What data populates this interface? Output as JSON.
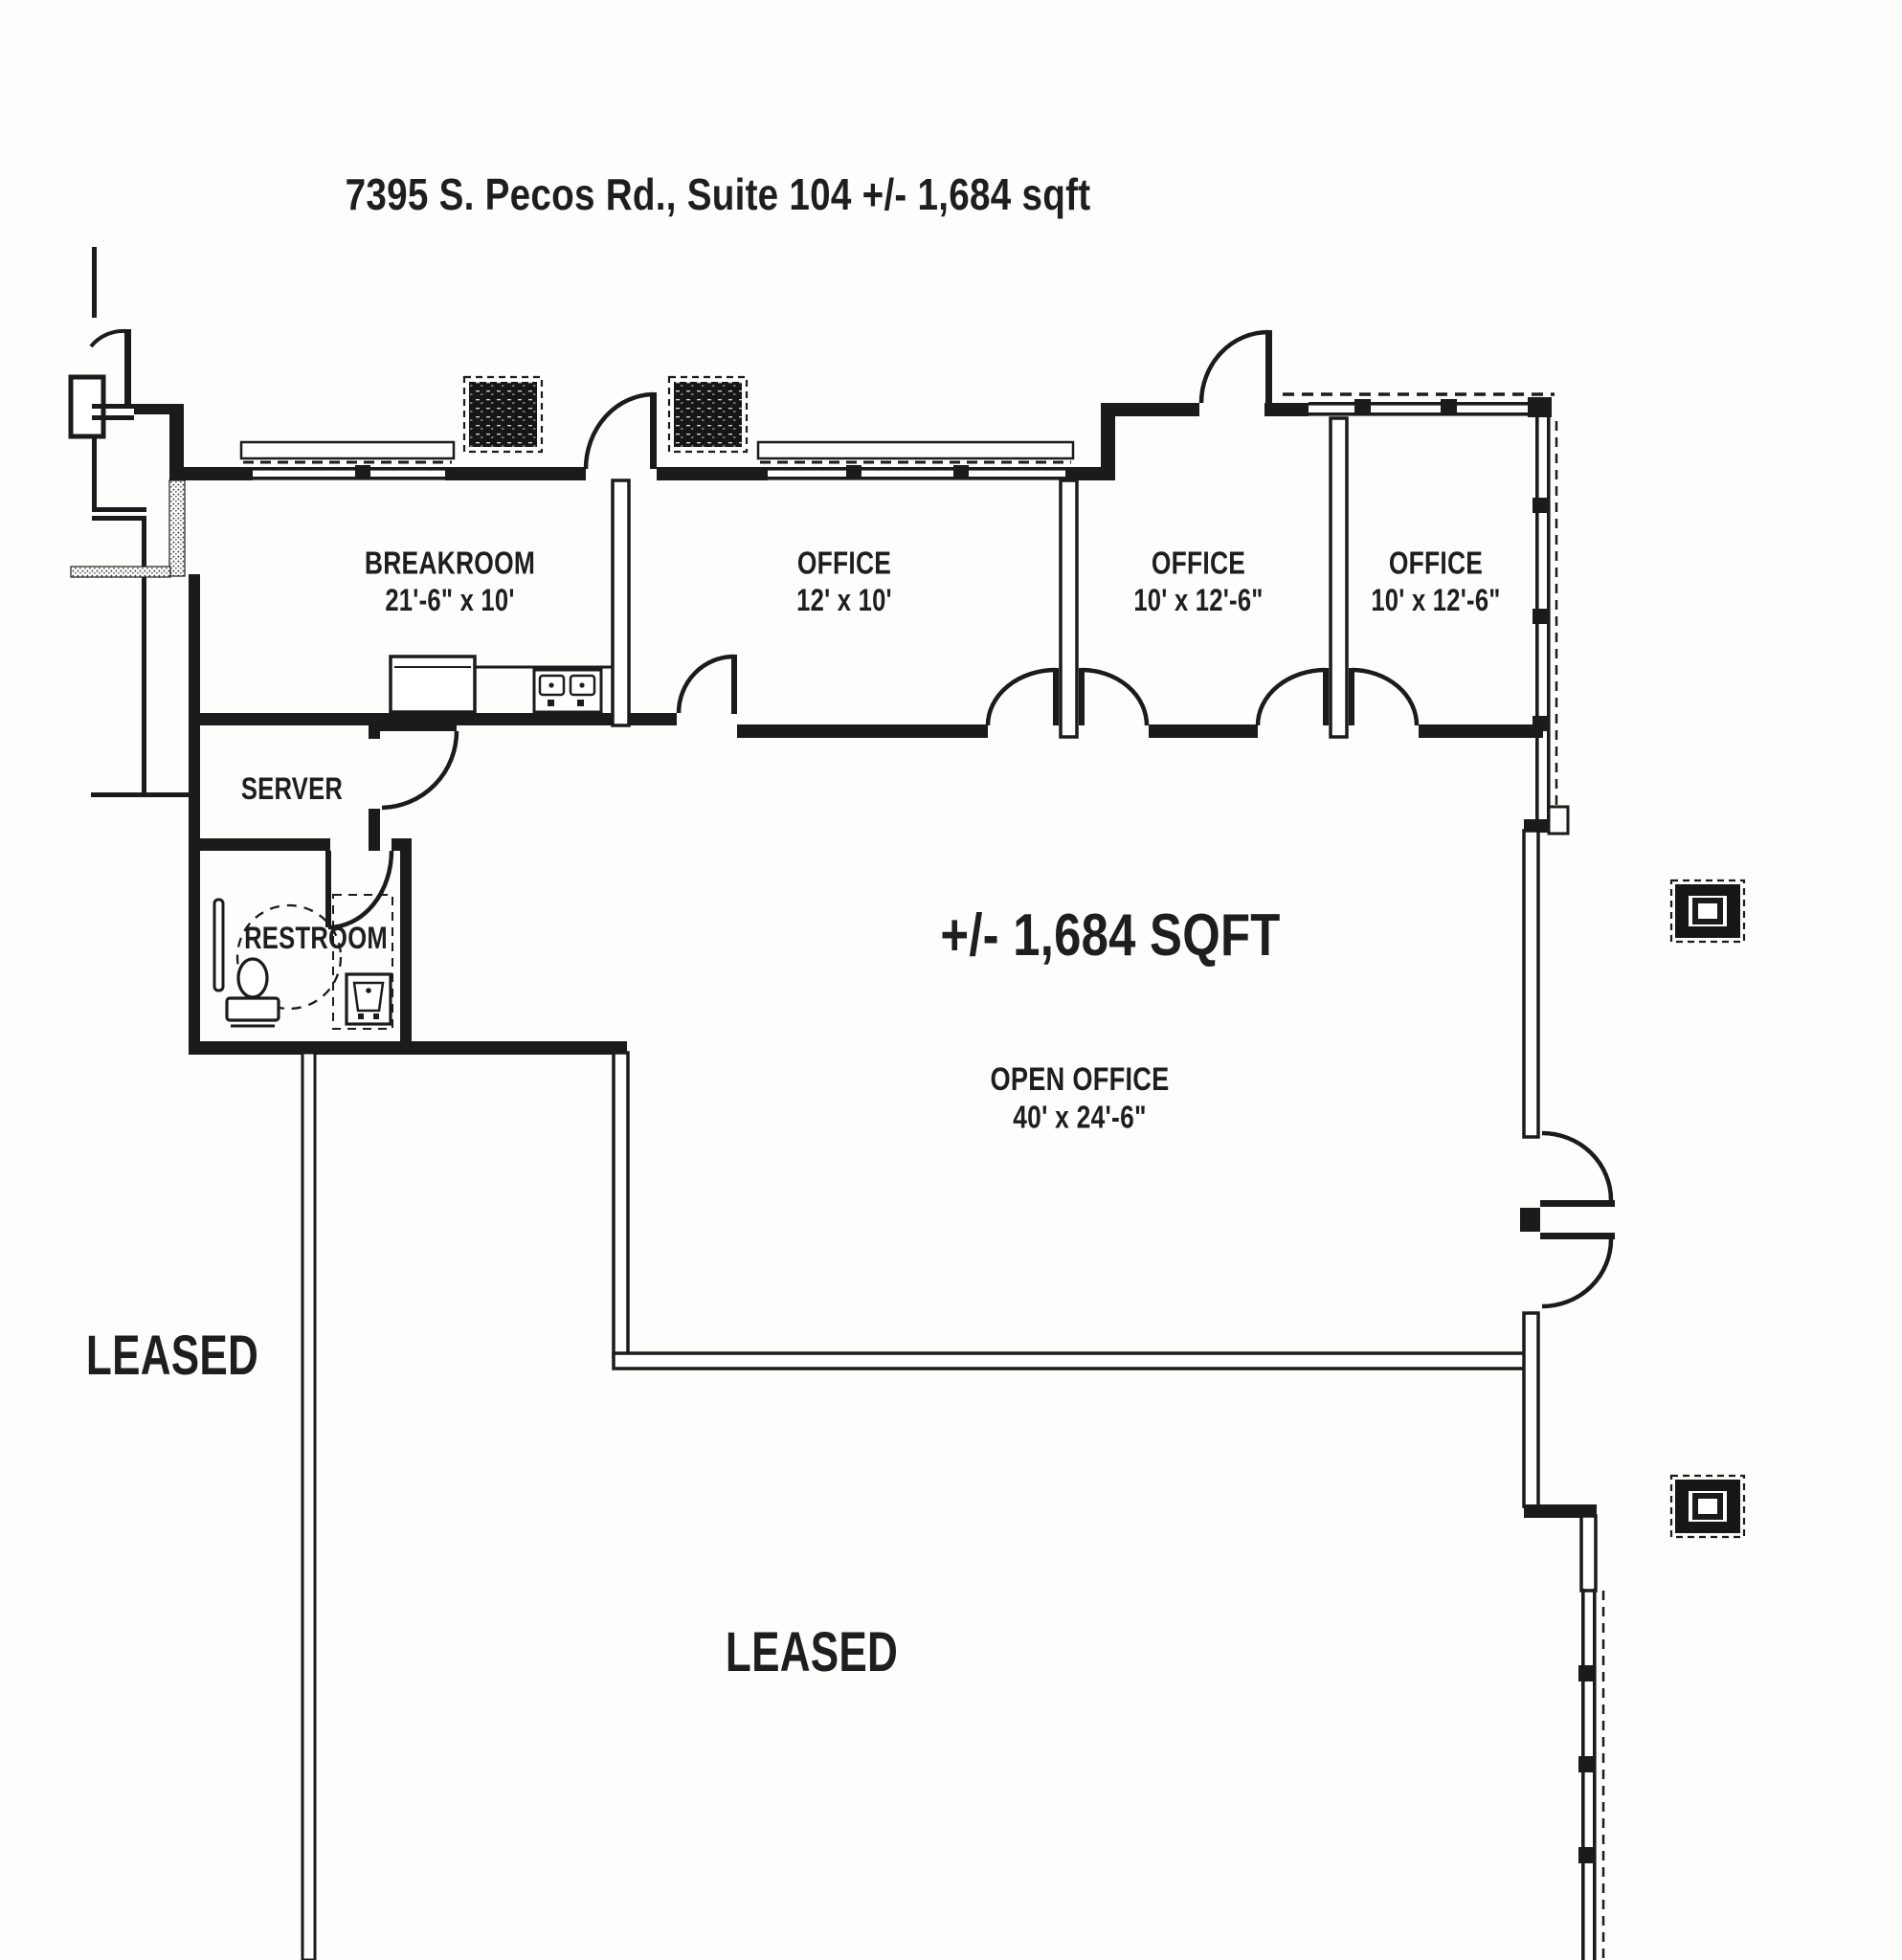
{
  "title": "7395 S. Pecos Rd., Suite 104   +/- 1,684 sqft",
  "plan": {
    "breakroom": {
      "name": "BREAKROOM",
      "dims": "21'-6\" x 10'"
    },
    "offices": [
      {
        "name": "OFFICE",
        "dims": "12' x 10'"
      },
      {
        "name": "OFFICE",
        "dims": "10' x 12'-6\""
      },
      {
        "name": "OFFICE",
        "dims": "10' x 12'-6\""
      }
    ],
    "server": {
      "name": "SERVER"
    },
    "restroom": {
      "name": "RESTROOM"
    },
    "open_office": {
      "area_text": "+/- 1,684 SQFT",
      "name": "OPEN OFFICE",
      "dims": "40' x 24'-6\""
    },
    "leased_left": {
      "name": "LEASED"
    },
    "leased_bottom": {
      "name": "LEASED"
    }
  },
  "colors": {
    "ink": "#1b1b1b",
    "paper": "#fdfdfb"
  }
}
